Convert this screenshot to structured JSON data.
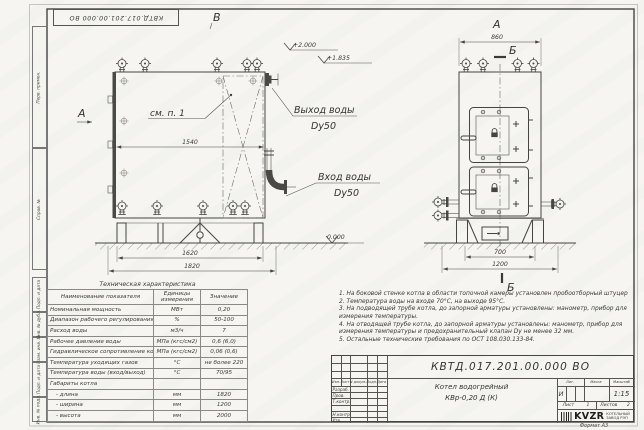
{
  "doc": {
    "number": "КВТД.017.201.00.000 ВО",
    "format": "Формат  А3"
  },
  "margin": {
    "labels": [
      "Перв. примен.",
      "Справ. №",
      "Подп. и дата",
      "Инв. № дубл.",
      "Взам. инв. №",
      "Подп. и дата",
      "Инв. № подл."
    ]
  },
  "front_view": {
    "mark_top": "В",
    "mark_side": "А",
    "callout": "см. п. 1",
    "outlet": {
      "line1": "Выход воды",
      "line2": "Dy50"
    },
    "inlet": {
      "line1": "Вход воды",
      "line2": "Dy50"
    },
    "elevations": {
      "top": "+2.000",
      "nozzle": "+1.835",
      "ground": "0.000"
    },
    "dims": {
      "inner": "1540",
      "frame": "1620",
      "overall": "1820"
    }
  },
  "side_view": {
    "title": "А",
    "section_top": "Б",
    "section_bottom": "Б",
    "dims": {
      "top": "860",
      "base": "700",
      "overall": "1200"
    }
  },
  "spec": {
    "title": "Техническая характеристика",
    "headers": [
      "Наименование показателя",
      "Единицы измерения",
      "Значение"
    ],
    "rows": [
      [
        "Номинальная мощность",
        "МВт",
        "0,20"
      ],
      [
        "Диапазон рабочего регулирования",
        "%",
        "50-100"
      ],
      [
        "Расход воды",
        "м3/ч",
        "7"
      ],
      [
        "Рабочее давление воды",
        "МПа (кгс/см2)",
        "0,6 (6,0)"
      ],
      [
        "Гидравлическое сопротивление котла",
        "МПа (кгс/см2)",
        "0,06 (0,6)"
      ],
      [
        "Температура уходящих газов",
        "°С",
        "не более 220"
      ],
      [
        "Температура воды (вход/выход)",
        "°С",
        "70/95"
      ],
      [
        "Габариты котла",
        "",
        ""
      ],
      [
        "- длина",
        "мм",
        "1820"
      ],
      [
        "- ширина",
        "мм",
        "1200"
      ],
      [
        "- высота",
        "мм",
        "2000"
      ]
    ]
  },
  "notes": [
    "1. На боковой стенке котла в области топочной камеры установлен пробоотборный штуцер",
    "2. Температура воды на входе 70°С, на выходе 95°С.",
    "3. На подводящей трубе котла, до запорной арматуры установлены: манометр, прибор для измерения температуры.",
    "4. На отводящей трубе котла, до запорной арматуры установлены: манометр, прибор для измерения температуры и предохранительный клапан Dу не менее 32 мм.",
    "5. Остальные технические требования по ОСТ 108.030.133-84."
  ],
  "titleblock": {
    "doc_number": "КВТД.017.201.00.000  ВО",
    "product_line1": "Котел водогрейный",
    "product_line2": "КВр-0,20 Д (К)",
    "header_cols": [
      "Изм.",
      "Лист",
      "N докум.",
      "Подп.",
      "Дата"
    ],
    "sign_rows": [
      "Разраб.",
      "Пров.",
      "Т.контр.",
      "Н.контр.",
      "Утв."
    ],
    "lit_label": "Лит.",
    "mass_label": "Масса",
    "scale_label": "Масштаб",
    "lit_value": "И",
    "scale_value": "1:15",
    "sheet_label": "Лист",
    "sheet_value": "1",
    "sheets_label": "Листов",
    "sheets_value": "2",
    "logo_text": "KVZR",
    "logo_tagline1": "КОТЕЛЬНЫЙ",
    "logo_tagline2": "ЗАВОД РЭП"
  }
}
